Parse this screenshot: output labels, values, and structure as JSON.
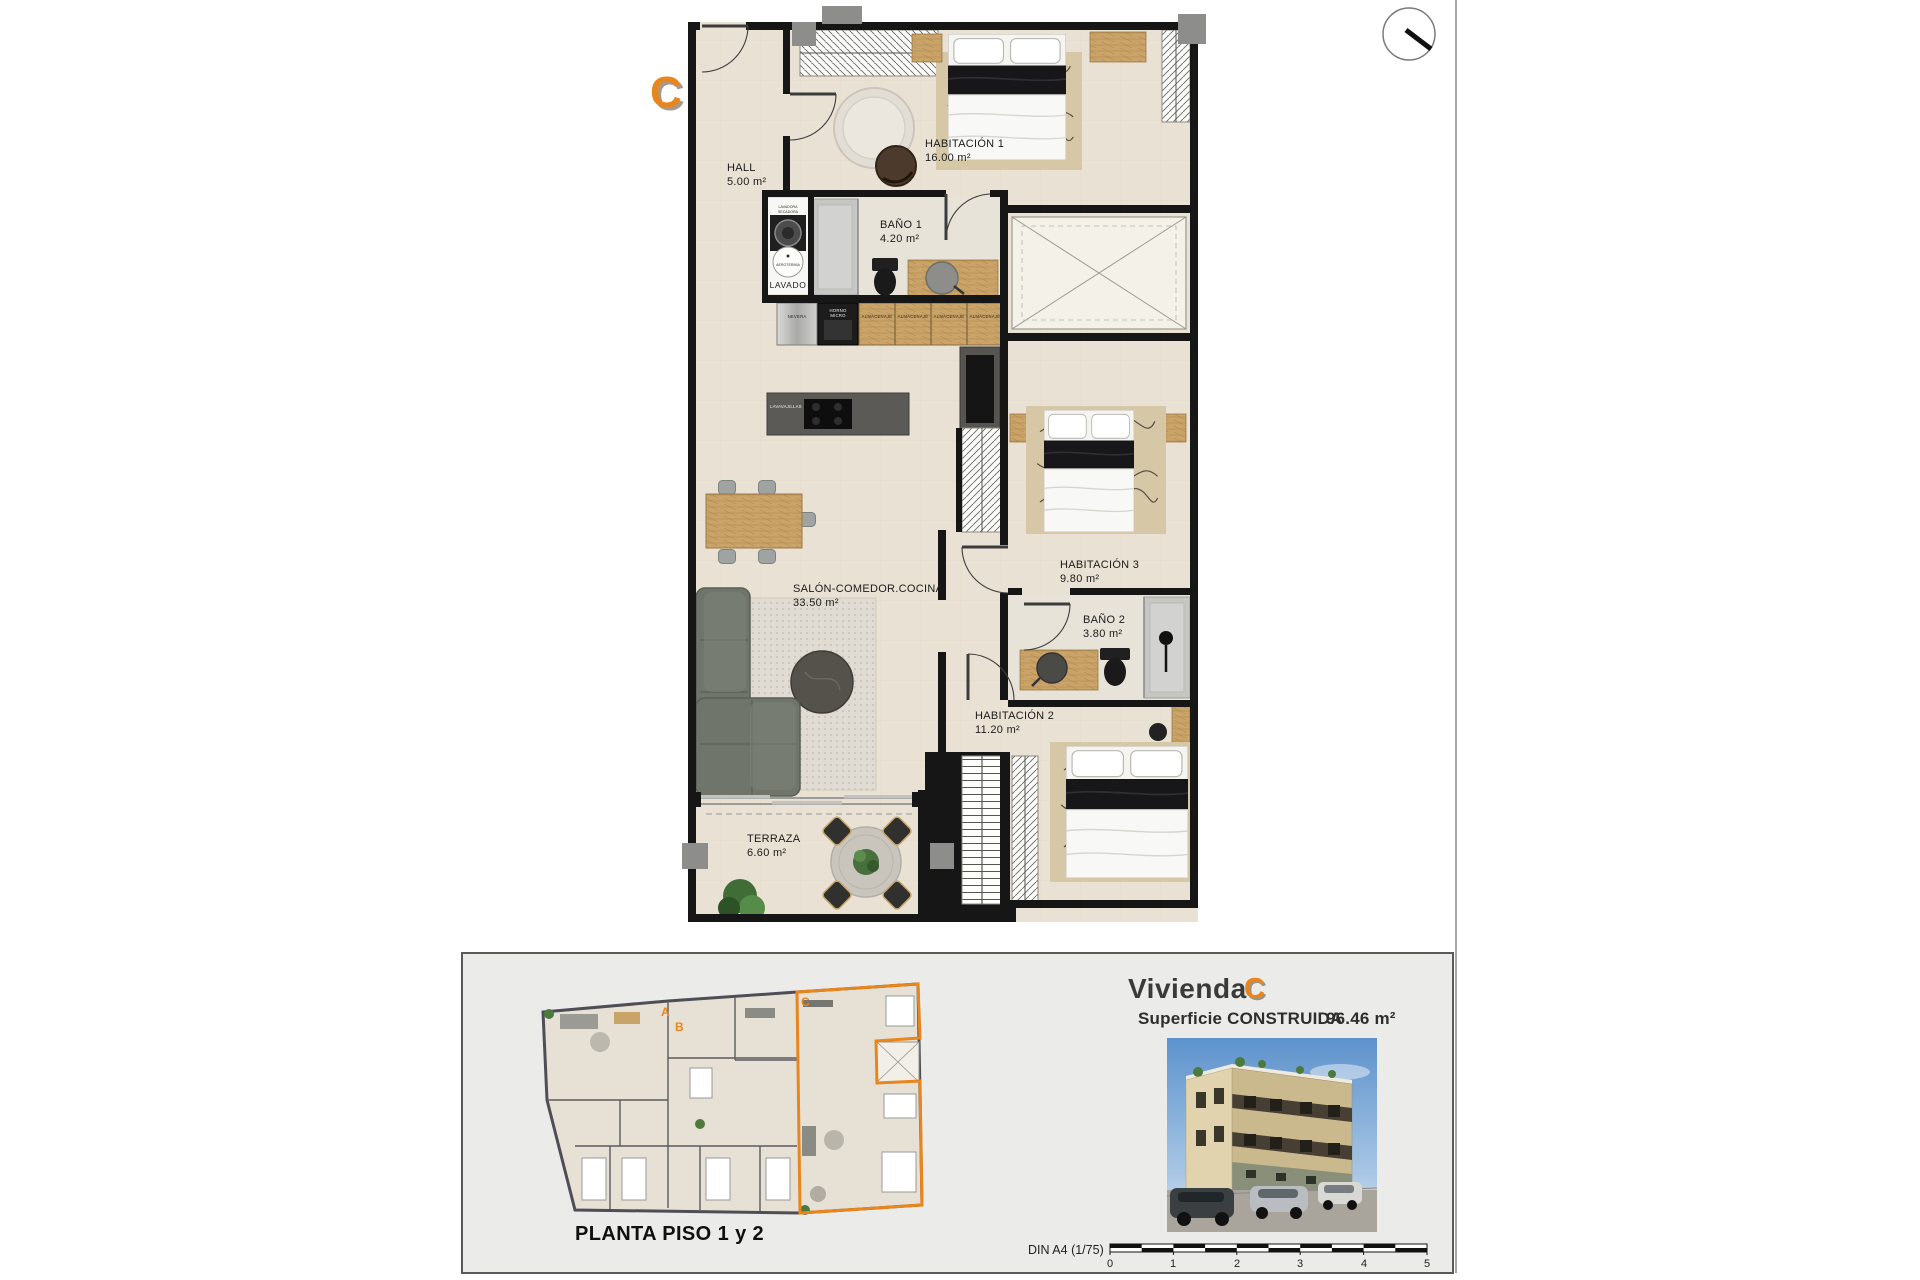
{
  "unit_letter": "C",
  "plan": {
    "rooms": [
      {
        "name": "HALL",
        "area": "5.00 m²"
      },
      {
        "name": "HABITACIÓN 1",
        "area": "16.00 m²"
      },
      {
        "name": "BAÑO 1",
        "area": "4.20 m²"
      },
      {
        "name": "SALÓN-COMEDOR.COCINA",
        "area": "33.50 m²"
      },
      {
        "name": "HABITACIÓN 3",
        "area": "9.80 m²"
      },
      {
        "name": "BAÑO 2",
        "area": "3.80 m²"
      },
      {
        "name": "HABITACIÓN 2",
        "area": "11.20 m²"
      },
      {
        "name": "TERRAZA",
        "area": "6.60 m²"
      }
    ],
    "labels": {
      "lavadora": "LAVADORA",
      "secadora": "SECADORA",
      "aerotermia": "AEROTERMIA",
      "lavado": "LAVADO",
      "nevera": "NEVERA",
      "horno": "HORNO",
      "micro": "MICRO",
      "almacenaje": "ALMACENAJE",
      "lavavajillas": "LAVAVAJILLAS"
    }
  },
  "footer": {
    "plan_title": "PLANTA PISO 1 y 2",
    "units": {
      "a": "A",
      "b": "B",
      "c": "C"
    },
    "vivienda_label": "Vivienda",
    "vivienda_unit": "C",
    "area_label": "Superficie CONSTRUIDA",
    "area_value": "96.46 m²",
    "scale_label": "DIN A4 (1/75)",
    "scale_ticks": [
      "0",
      "1",
      "2",
      "3",
      "4",
      "5"
    ]
  },
  "colors": {
    "accent_orange": "#E8861D",
    "wall_black": "#161616",
    "floor_beige": "#E9E1D3",
    "panel_gray": "#EBEBE9"
  }
}
